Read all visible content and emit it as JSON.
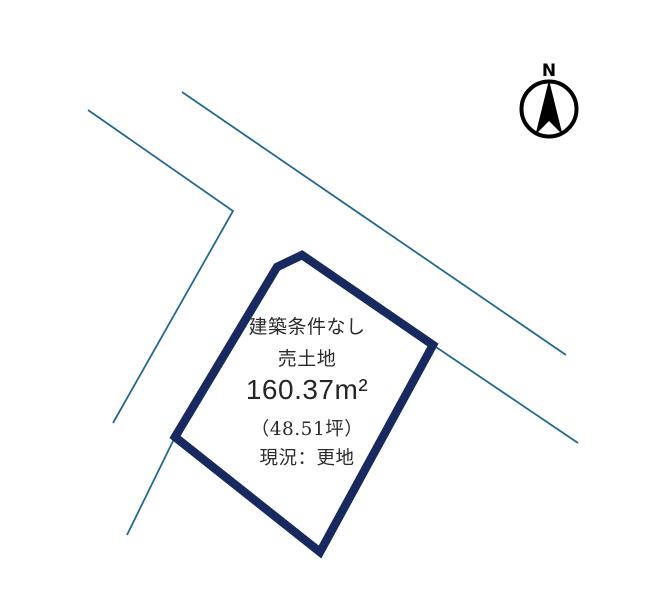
{
  "compass": {
    "north_label": "N",
    "color": "#000000",
    "circle": {
      "cx": 549,
      "cy": 109,
      "r": 27.5
    },
    "arrow_points": "549,80 562.5,134.5 549,121 535.5,134.5"
  },
  "parcel": {
    "outline_color": "#17295e",
    "fill_color": "#ffffff",
    "stroke_width": 8.5,
    "points": "277,267 302,255 433,345 320,552 175,437"
  },
  "roads": {
    "color": "#24688e",
    "stroke_width": 1.8,
    "lines": [
      {
        "points": "88,110 233,211 113,423"
      },
      {
        "points": "182,92 566,355"
      },
      {
        "points": "175,437 127,535"
      },
      {
        "points": "433,345 578,443"
      }
    ]
  },
  "labels": {
    "condition": "建築条件なし",
    "sale_type": "売土地",
    "area_m2": "160.37m²",
    "area_tsubo": "（48.51坪）",
    "status": "現況：更地",
    "text_color": "#2b2b2b"
  }
}
